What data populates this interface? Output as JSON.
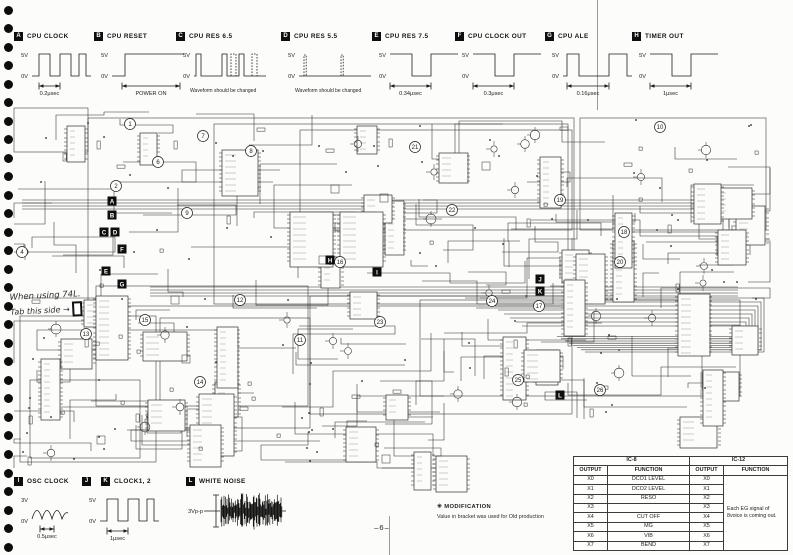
{
  "page": {
    "number": "–6–"
  },
  "decor": {
    "binder_holes": 30,
    "paper": "#fcfcfa",
    "ink": "#1d1d1b"
  },
  "waveform_key": [
    {
      "id": "A",
      "title": "CPU CLOCK",
      "levels": [
        "5V",
        "0V"
      ],
      "annotation": "0.2μsec",
      "shape": "square"
    },
    {
      "id": "B",
      "title": "CPU RESET",
      "levels": [
        "5V",
        "0V"
      ],
      "annotation": "POWER ON",
      "shape": "step"
    },
    {
      "id": "C",
      "title": "CPU RES 6.5",
      "levels": [
        "5V",
        "0V"
      ],
      "annotation": "Waveform should be changed",
      "shape": "pulses"
    },
    {
      "id": "D",
      "title": "CPU RES 5.5",
      "levels": [
        "5V",
        "0V"
      ],
      "annotation": "Waveform should be changed",
      "shape": "spikes"
    },
    {
      "id": "E",
      "title": "CPU RES 7.5",
      "levels": [
        "5V",
        "0V"
      ],
      "annotation": "0.34μsec",
      "shape": "squarewide"
    },
    {
      "id": "F",
      "title": "CPU CLOCK OUT",
      "levels": [
        "5V",
        "0V"
      ],
      "annotation": "0.3μsec",
      "shape": "squarewide"
    },
    {
      "id": "G",
      "title": "CPU ALE",
      "levels": [
        "5V",
        "0V"
      ],
      "annotation": "0.16μsec",
      "shape": "pulse"
    },
    {
      "id": "H",
      "title": "TIMER OUT",
      "levels": [
        "5V",
        "0V"
      ],
      "annotation": "1μsec",
      "shape": "squarewide"
    }
  ],
  "waveform_key_bottom": [
    {
      "ids": [
        "I"
      ],
      "title": "OSC CLOCK",
      "levels": [
        "3V",
        "0V"
      ],
      "annotation": "0.5μsec",
      "shape": "sine"
    },
    {
      "ids": [
        "J",
        "K"
      ],
      "title": "CLOCK1, 2",
      "levels": [
        "5V",
        "0V"
      ],
      "annotation": "1μsec",
      "shape": "square"
    },
    {
      "ids": [
        "L"
      ],
      "title": "WHITE NOISE",
      "levels": [
        "3Vp-p"
      ],
      "annotation": "",
      "shape": "noise"
    }
  ],
  "modification_note": {
    "title": "✳ MODIFICATION",
    "body": "Value in bracket was used for Old production"
  },
  "ic_table": {
    "groups": [
      "IC-8",
      "IC-12"
    ],
    "headers": [
      "OUTPUT",
      "FUNCTION",
      "OUTPUT",
      "FUNCTION"
    ],
    "rows": [
      [
        "X0",
        "DCO1 LEVEL",
        "X0"
      ],
      [
        "X1",
        "DCO2 LEVEL",
        "X1"
      ],
      [
        "X2",
        "RESO",
        "X2"
      ],
      [
        "X3",
        "",
        "X3"
      ],
      [
        "X4",
        "CUT OFF",
        "X4"
      ],
      [
        "X5",
        "MG",
        "X5"
      ],
      [
        "X6",
        "VIB",
        "X6"
      ],
      [
        "X7",
        "BEND",
        "X7"
      ]
    ],
    "merged_function": "Each EG signal of 8voice is coming out."
  },
  "handwritten_note": {
    "lines": [
      "When using 74L.",
      "Tab this side →"
    ]
  },
  "schematic": {
    "test_points": [
      {
        "label": "A",
        "x": 112,
        "y": 201
      },
      {
        "label": "B",
        "x": 112,
        "y": 215
      },
      {
        "label": "C",
        "x": 104,
        "y": 232
      },
      {
        "label": "D",
        "x": 115,
        "y": 232
      },
      {
        "label": "F",
        "x": 122,
        "y": 249
      },
      {
        "label": "E",
        "x": 106,
        "y": 271
      },
      {
        "label": "G",
        "x": 122,
        "y": 284
      },
      {
        "label": "H",
        "x": 330,
        "y": 260
      },
      {
        "label": "I",
        "x": 377,
        "y": 272
      },
      {
        "label": "J",
        "x": 540,
        "y": 279
      },
      {
        "label": "K",
        "x": 540,
        "y": 291
      },
      {
        "label": "L",
        "x": 560,
        "y": 395
      }
    ],
    "circled_numbers": [
      {
        "n": "1",
        "x": 130,
        "y": 124
      },
      {
        "n": "2",
        "x": 116,
        "y": 186
      },
      {
        "n": "4",
        "x": 22,
        "y": 252
      },
      {
        "n": "6",
        "x": 158,
        "y": 162
      },
      {
        "n": "7",
        "x": 203,
        "y": 136
      },
      {
        "n": "8",
        "x": 251,
        "y": 151
      },
      {
        "n": "9",
        "x": 187,
        "y": 213
      },
      {
        "n": "10",
        "x": 660,
        "y": 127
      },
      {
        "n": "11",
        "x": 300,
        "y": 340
      },
      {
        "n": "12",
        "x": 240,
        "y": 300
      },
      {
        "n": "13",
        "x": 86,
        "y": 334
      },
      {
        "n": "14",
        "x": 200,
        "y": 382
      },
      {
        "n": "15",
        "x": 145,
        "y": 320
      },
      {
        "n": "16",
        "x": 340,
        "y": 262
      },
      {
        "n": "17",
        "x": 539,
        "y": 306
      },
      {
        "n": "18",
        "x": 624,
        "y": 232
      },
      {
        "n": "19",
        "x": 560,
        "y": 200
      },
      {
        "n": "20",
        "x": 620,
        "y": 262
      },
      {
        "n": "21",
        "x": 415,
        "y": 147
      },
      {
        "n": "22",
        "x": 452,
        "y": 210
      },
      {
        "n": "23",
        "x": 380,
        "y": 322
      },
      {
        "n": "24",
        "x": 492,
        "y": 301
      },
      {
        "n": "25",
        "x": 518,
        "y": 380
      },
      {
        "n": "26",
        "x": 600,
        "y": 390
      }
    ]
  }
}
